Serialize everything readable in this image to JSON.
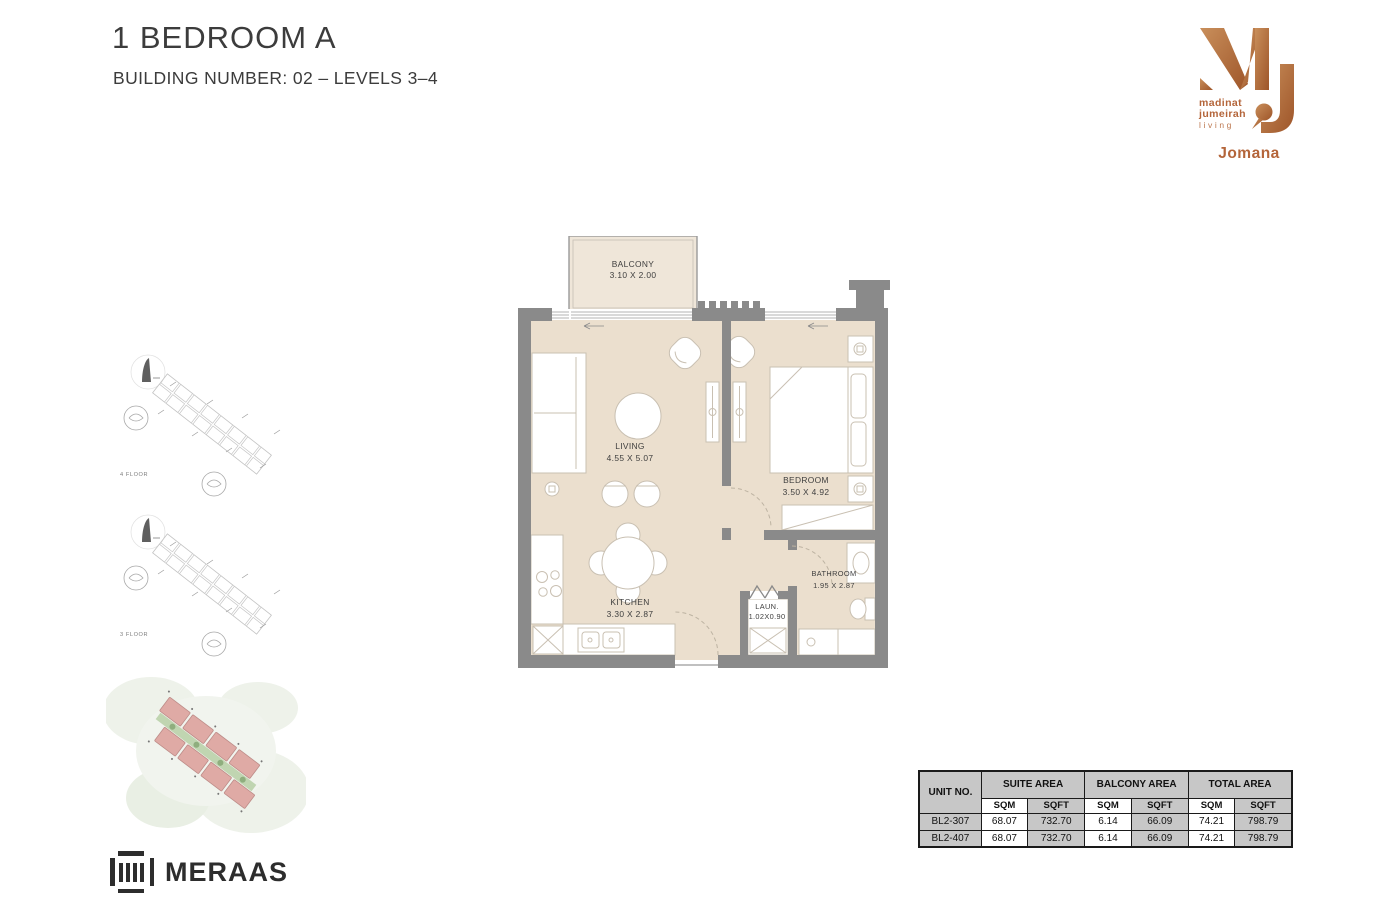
{
  "header": {
    "title": "1 BEDROOM A",
    "subtitle": "BUILDING NUMBER: 02 – LEVELS 3–4"
  },
  "brand": {
    "monogram": "MJ",
    "name_line1": "madinat",
    "name_line2": "jumeirah",
    "name_line3": "living",
    "project": "Jomana"
  },
  "floorplan": {
    "rooms": {
      "balcony": {
        "name": "BALCONY",
        "dims": "3.10 X 2.00"
      },
      "living": {
        "name": "LIVING",
        "dims": "4.55 X 5.07"
      },
      "bedroom": {
        "name": "BEDROOM",
        "dims": "3.50 X 4.92"
      },
      "kitchen": {
        "name": "KITCHEN",
        "dims": "3.30 X 2.87"
      },
      "laundry": {
        "name": "LAUN.",
        "dims": "1.02X0.90"
      },
      "bathroom": {
        "name": "BATHROOM",
        "dims": "1.95 X 2.87"
      }
    }
  },
  "keyplans": [
    {
      "label": "4 FLOOR"
    },
    {
      "label": "3 FLOOR"
    }
  ],
  "table": {
    "unit_col": "UNIT NO.",
    "groups": [
      "SUITE AREA",
      "BALCONY AREA",
      "TOTAL AREA"
    ],
    "sub_headers": [
      "SQM",
      "SQFT",
      "SQM",
      "SQFT",
      "SQM",
      "SQFT"
    ],
    "rows": [
      {
        "unit": "BL2-307",
        "values": [
          "68.07",
          "732.70",
          "6.14",
          "66.09",
          "74.21",
          "798.79"
        ]
      },
      {
        "unit": "BL2-407",
        "values": [
          "68.07",
          "732.70",
          "6.14",
          "66.09",
          "74.21",
          "798.79"
        ]
      }
    ]
  },
  "footer": {
    "brand": "MERAAS"
  },
  "colors": {
    "copper": "#b4653a",
    "wall_gray": "#8a8a8a",
    "floor_beige": "#ebdfce",
    "balcony_beige": "#efe6d9",
    "table_header_gray": "#c7c7c7",
    "site_block_pink": "#dfaaa5",
    "text_dark": "#3c3c3c"
  }
}
